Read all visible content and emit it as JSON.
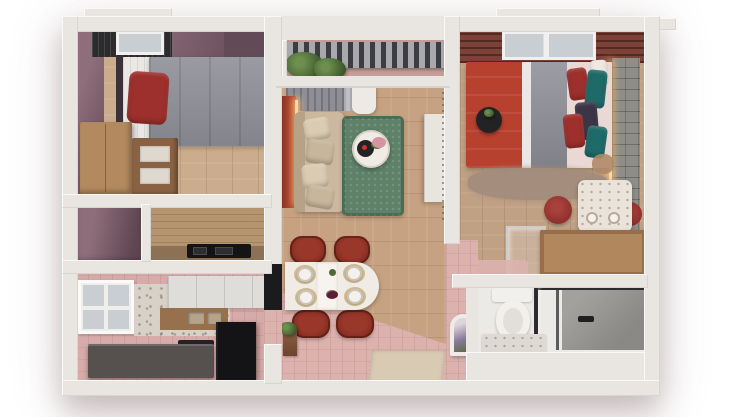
{
  "scene": {
    "title": "Two-bedroom apartment — top-down 3D floor plan render",
    "type": "3d-floor-plan-render",
    "background": "#ffffff"
  },
  "rooms": [
    {
      "id": "bedroom-1",
      "label": "Bedroom 1",
      "furniture": [
        "single bed with grey blanket and red pillow",
        "tan wardrobe dresser",
        "wooden nightstand",
        "roof window with dark blinds"
      ]
    },
    {
      "id": "balcony",
      "label": "Balcony",
      "furniture": [
        "slatted railing",
        "potted green plants"
      ]
    },
    {
      "id": "living-dining",
      "label": "Living room & dining area",
      "furniture": [
        "beige sofa with cushions",
        "green rug",
        "round coffee table with tray and flowers",
        "white media console",
        "red tall cabinet",
        "grey curtains",
        "oval dining table with four place settings",
        "four dark-red chairs",
        "entrance door mat",
        "plant stand"
      ]
    },
    {
      "id": "bedroom-2",
      "label": "Bedroom 2",
      "furniture": [
        "double bed with red and grey blankets",
        "teal and navy pillows",
        "black round bedside table with plant",
        "brick headboard wall with LED strip",
        "fluffy rug",
        "red poufs",
        "vanity dressing table",
        "tan dresser",
        "glass side table",
        "pink rug"
      ]
    },
    {
      "id": "closet",
      "label": "Closet",
      "furniture": []
    },
    {
      "id": "cooktop-nook",
      "label": "Cooktop nook",
      "furniture": [
        "wood plank wall",
        "black cooktop on counter"
      ]
    },
    {
      "id": "kitchen",
      "label": "Kitchen",
      "furniture": [
        "window",
        "white upper cabinets",
        "terrazzo backsplash",
        "wood counter with sink",
        "graphite counter",
        "black fridge unit"
      ]
    },
    {
      "id": "bathroom",
      "label": "Bathroom",
      "furniture": [
        "toilet",
        "glass shower screen",
        "grey shower tray",
        "stone shelf"
      ]
    },
    {
      "id": "hallway",
      "label": "Hallway",
      "furniture": [
        "arched mirror with dried lavender"
      ]
    }
  ],
  "palette": {
    "bg": "#ffffff",
    "wall": "#e9e6e1",
    "mauveWall": "#8f6e7b",
    "mauveDark": "#634a57",
    "closetDark": "#5f4652",
    "floorWood": "#cbac8d",
    "floorWoodCenter": "#c6a282",
    "floorWood2": "#c0a184",
    "floorPink": "#dcb2ae",
    "balconyFloor": "#c69d99",
    "blanketGray": "#8f8f98",
    "sheetWhite": "#eae7e4",
    "pillowRed": "#9d2f2c",
    "headboardDark": "#3a3236",
    "dresserTan": "#b3895f",
    "woodDark": "#8a6243",
    "blindDark": "#2c2c2f",
    "paneGray": "#c9ced3",
    "railSlat": "#3c3d42",
    "railBase": "#a9a9ad",
    "plantGreen": "#4c6b38",
    "curtainGray": "#8e8e96",
    "curtainLight": "#bebec4",
    "curtainWhite": "#edeae6",
    "accentRed": "#c25038",
    "ledGlow": "#ffd9a2",
    "sofaBeige": "#cbb89e",
    "sofaBack": "#b5a287",
    "pillowBeige": "#dacbb2",
    "pillowBeige2": "#c8b69c",
    "rugGreen": "#5e8168",
    "tableWhite": "#f0ebe4",
    "trayBlack": "#232325",
    "flowerPink": "#d893a0",
    "consoleWhite": "#e8e4de",
    "pergola": "#7c4237",
    "bedRed": "#b7402f",
    "tealPillow": "#1e6a68",
    "navyPillow": "#3b3546",
    "pinkSheet": "#ead8d4",
    "brickWall": "#8f8d88",
    "rugTaupe": "#a28c7c",
    "poufRed": "#8c2e2c",
    "vanityWhite": "#eae3da",
    "dresser2Tan": "#b1885e",
    "chairRed": "#7d2a1f",
    "chairRedLight": "#98372a",
    "placematGold": "#c9b183",
    "plateWhite": "#f4f1ec",
    "counterGraphite": "#56504e",
    "unitBlack": "#141417",
    "counterWood": "#97714d",
    "nookWood": "#b4956f",
    "nookCounter": "#8d7154",
    "terrazzo": "#d8d1c8",
    "cabinetWhite": "#deddd9",
    "sinkBeige": "#b5a489",
    "toiletWhite": "#f2f0ed",
    "showerGray": "#a3a19d",
    "showerDark": "#8b8985",
    "glassFrame": "#2c2c2e",
    "marbleLight": "#dedad3",
    "matBeige": "#d9cab4",
    "mirrorWhite": "#efece7",
    "lavender": "#8a7a9a",
    "doorwayDark": "#1b1b1e"
  }
}
